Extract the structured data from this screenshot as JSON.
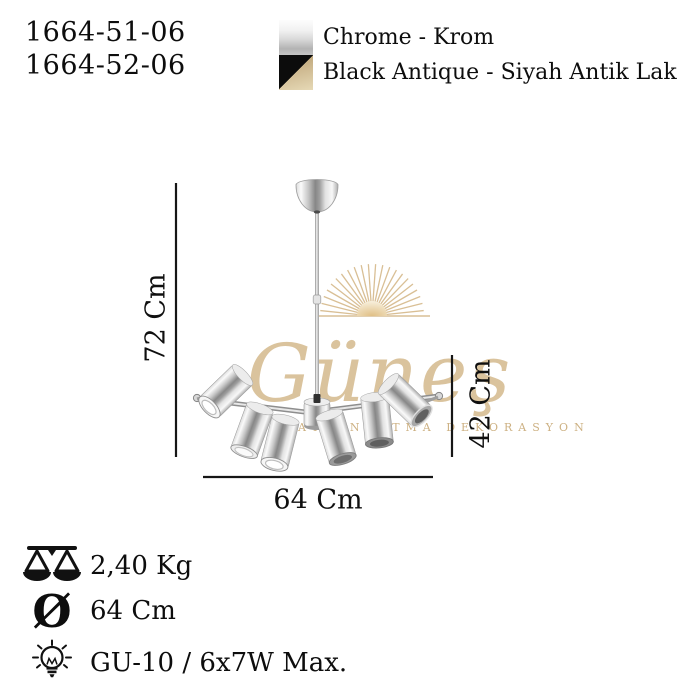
{
  "product": {
    "codes": [
      "1664-51-06",
      "1664-52-06"
    ]
  },
  "finishes": [
    {
      "name": "chrome",
      "label": "Chrome - Krom"
    },
    {
      "name": "black-antique",
      "label": "Black Antique - Siyah Antik Lak"
    }
  ],
  "dimensions": {
    "height": "72 Cm",
    "body_height": "42 Cm",
    "width": "64 Cm"
  },
  "watermark": {
    "brand": "Güneş",
    "tagline": "AYDINLATMA DEKORASYON",
    "gold": "#d4b98c"
  },
  "specs": [
    {
      "icon": "scale-icon",
      "value": "2,40 Kg"
    },
    {
      "icon": "diameter-icon",
      "symbol": "Ø",
      "value": "64 Cm"
    },
    {
      "icon": "bulb-icon",
      "value": "GU-10 / 6x7W Max."
    }
  ],
  "colors": {
    "text": "#111111",
    "dimension_line": "#161616",
    "watermark_gold": "#d4b98c",
    "swatch_black": "#0c0c0c",
    "swatch_tan": "#cdb88f"
  }
}
